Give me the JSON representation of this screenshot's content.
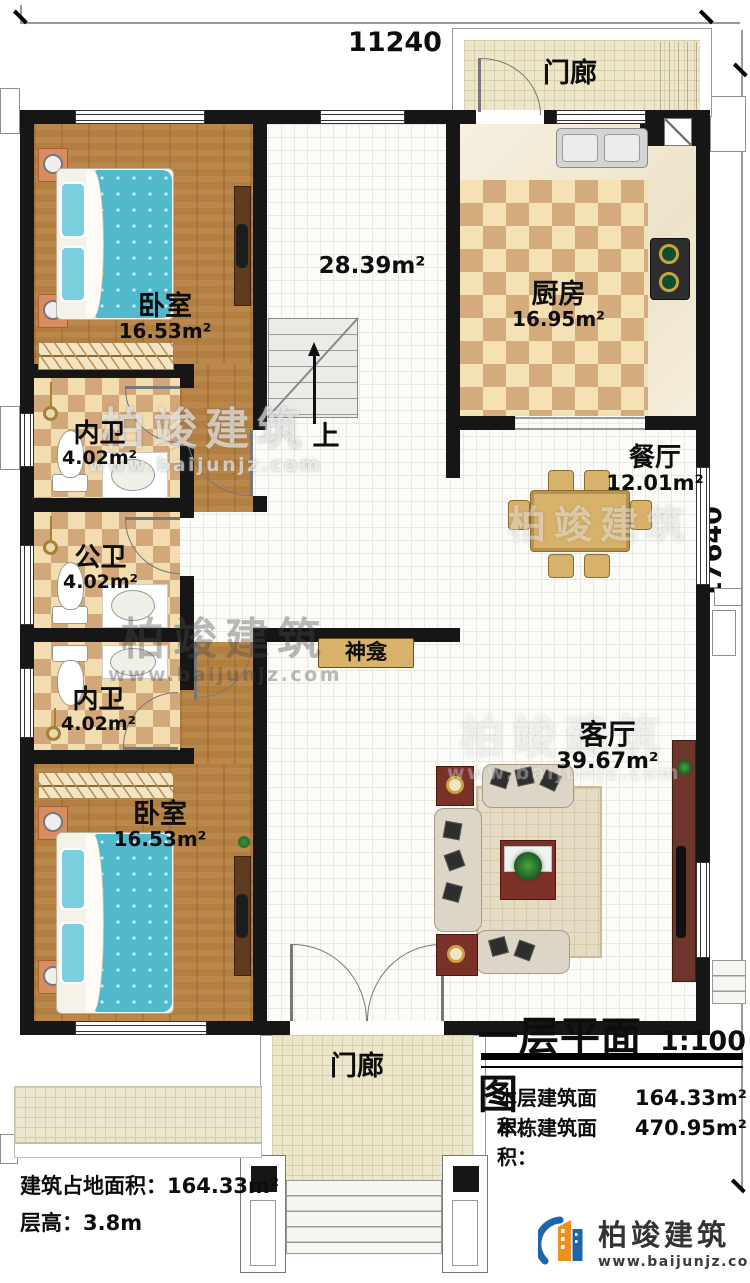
{
  "dimensions": {
    "top": "11240",
    "right": "17640"
  },
  "rooms": [
    {
      "name": "卧室",
      "area": "16.53m²"
    },
    {
      "name": "内卫",
      "area": "4.02m²"
    },
    {
      "name": "公卫",
      "area": "4.02m²"
    },
    {
      "name": "内卫",
      "area": "4.02m²"
    },
    {
      "name": "卧室",
      "area": "16.53m²"
    },
    {
      "name": "厨房",
      "area": "16.95m²"
    },
    {
      "name": "餐厅",
      "area": "12.01m²"
    },
    {
      "name": "客厅",
      "area": "39.67m²"
    }
  ],
  "hall_area": "28.39m²",
  "labels": {
    "stairs_up": "上",
    "shrine": "神龛",
    "porch": "门廊"
  },
  "title_block": {
    "title": "一层平面图",
    "scale": "1:100",
    "rows": [
      {
        "label": "本层建筑面积：",
        "value": "164.33m²"
      },
      {
        "label": "本栋建筑面积：",
        "value": "470.95m²"
      }
    ]
  },
  "footer": {
    "rows": [
      {
        "label": "建筑占地面积：",
        "value": "164.33m²"
      },
      {
        "label": "层高：",
        "value": "3.8m"
      }
    ]
  },
  "brand": {
    "name": "柏竣建筑",
    "url": "www.baijunjz.com"
  }
}
